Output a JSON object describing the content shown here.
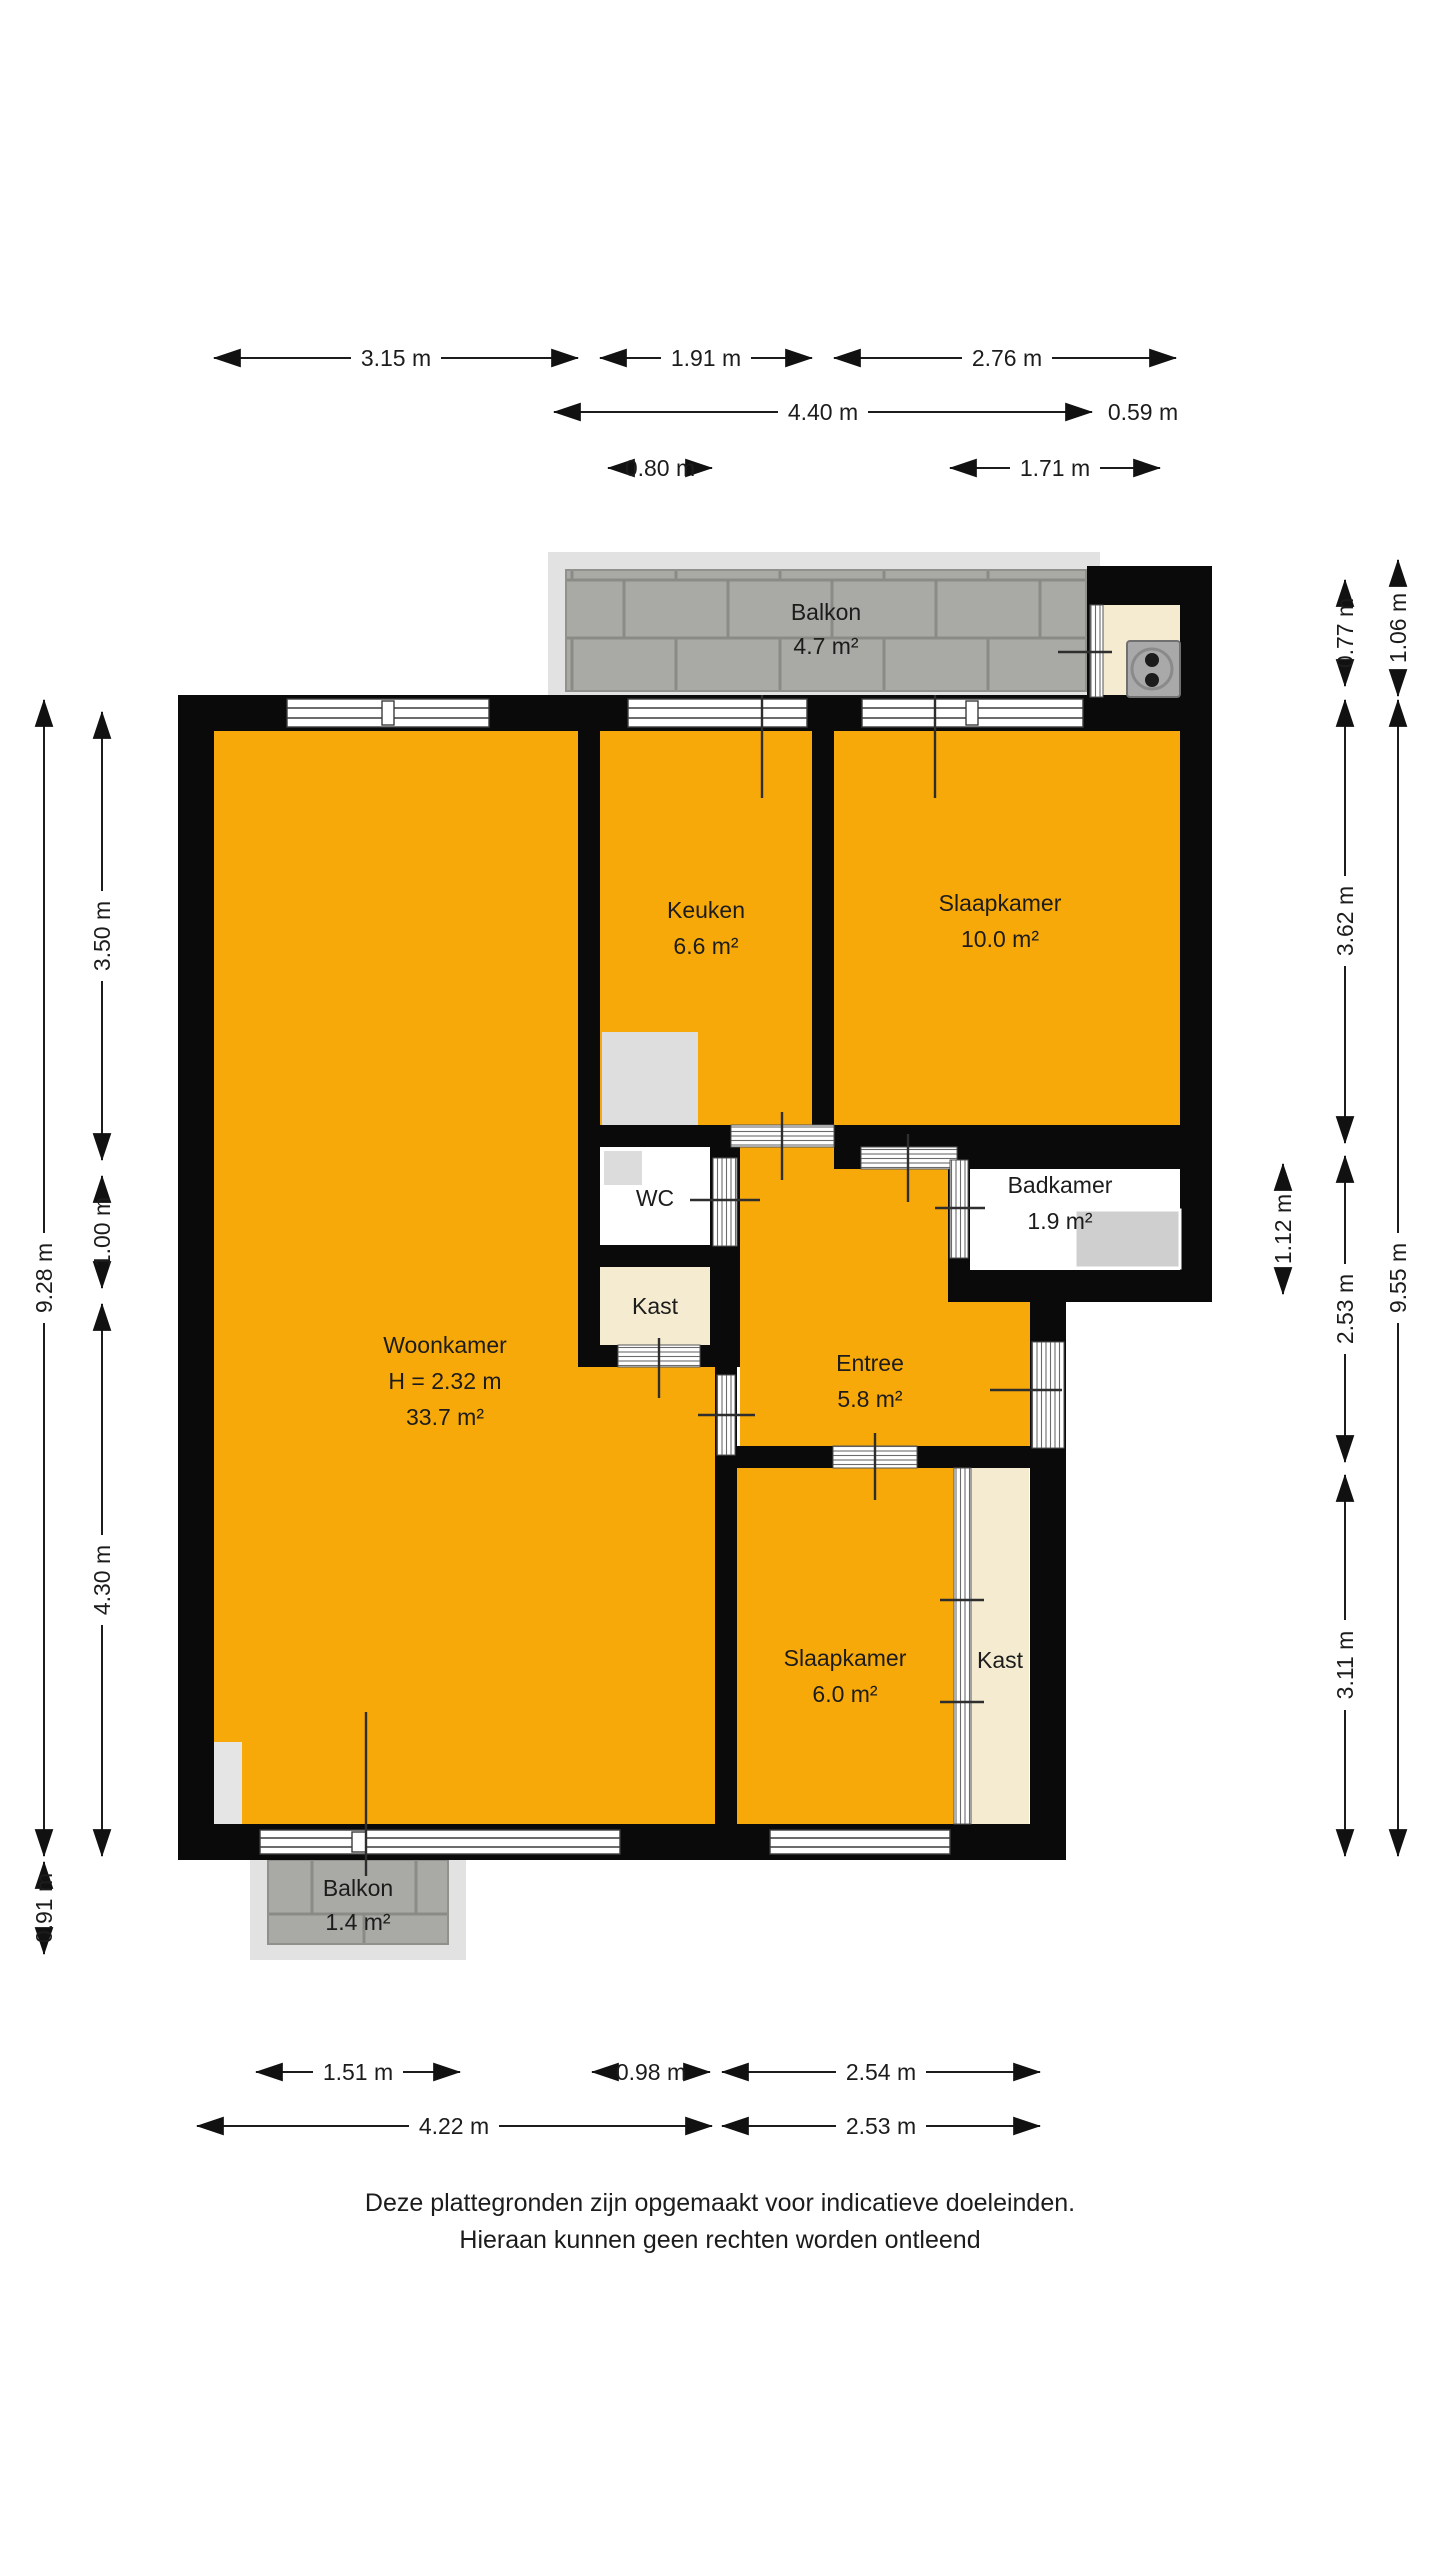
{
  "title": "Floor plan (plattegrond)",
  "rooms": {
    "balkon_top": {
      "name": "Balkon",
      "area": "4.7 m²"
    },
    "keuken": {
      "name": "Keuken",
      "area": "6.6 m²"
    },
    "slaapkamer1": {
      "name": "Slaapkamer",
      "area": "10.0 m²"
    },
    "woonkamer": {
      "name": "Woonkamer",
      "height": "H = 2.32 m",
      "area": "33.7 m²"
    },
    "wc": {
      "name": "WC"
    },
    "badkamer": {
      "name": "Badkamer",
      "area": "1.9 m²"
    },
    "kast1": {
      "name": "Kast"
    },
    "entree": {
      "name": "Entree",
      "area": "5.8 m²"
    },
    "slaapkamer2": {
      "name": "Slaapkamer",
      "area": "6.0 m²"
    },
    "kast2": {
      "name": "Kast"
    },
    "balkon_bottom": {
      "name": "Balkon",
      "area": "1.4 m²"
    }
  },
  "dimensions": {
    "top": [
      "3.15 m",
      "1.91 m",
      "2.76 m",
      "4.40 m",
      "0.59 m",
      "0.80 m",
      "1.71 m"
    ],
    "bottom": [
      "1.51 m",
      "0.98 m",
      "2.54 m",
      "4.22 m",
      "2.53 m"
    ],
    "left": [
      "9.28 m",
      "3.50 m",
      "1.00 m",
      "4.30 m",
      "0.91 m"
    ],
    "right": [
      "1.06 m",
      "0.77 m",
      "3.62 m",
      "9.55 m",
      "1.12 m",
      "2.53 m",
      "3.11 m"
    ]
  },
  "footer": {
    "line1": "Deze plattegronden zijn opgemaakt voor indicatieve doeleinden.",
    "line2": "Hieraan kunnen geen rechten worden ontleend"
  },
  "colors": {
    "floor_orange": "#F8A90A",
    "wall_black": "#0a0a0a",
    "closet_beige": "#F4EBD0",
    "tile_gray": "#A9A9A5",
    "deck_gray": "#E2E2E2",
    "text": "#1c1c1c"
  }
}
